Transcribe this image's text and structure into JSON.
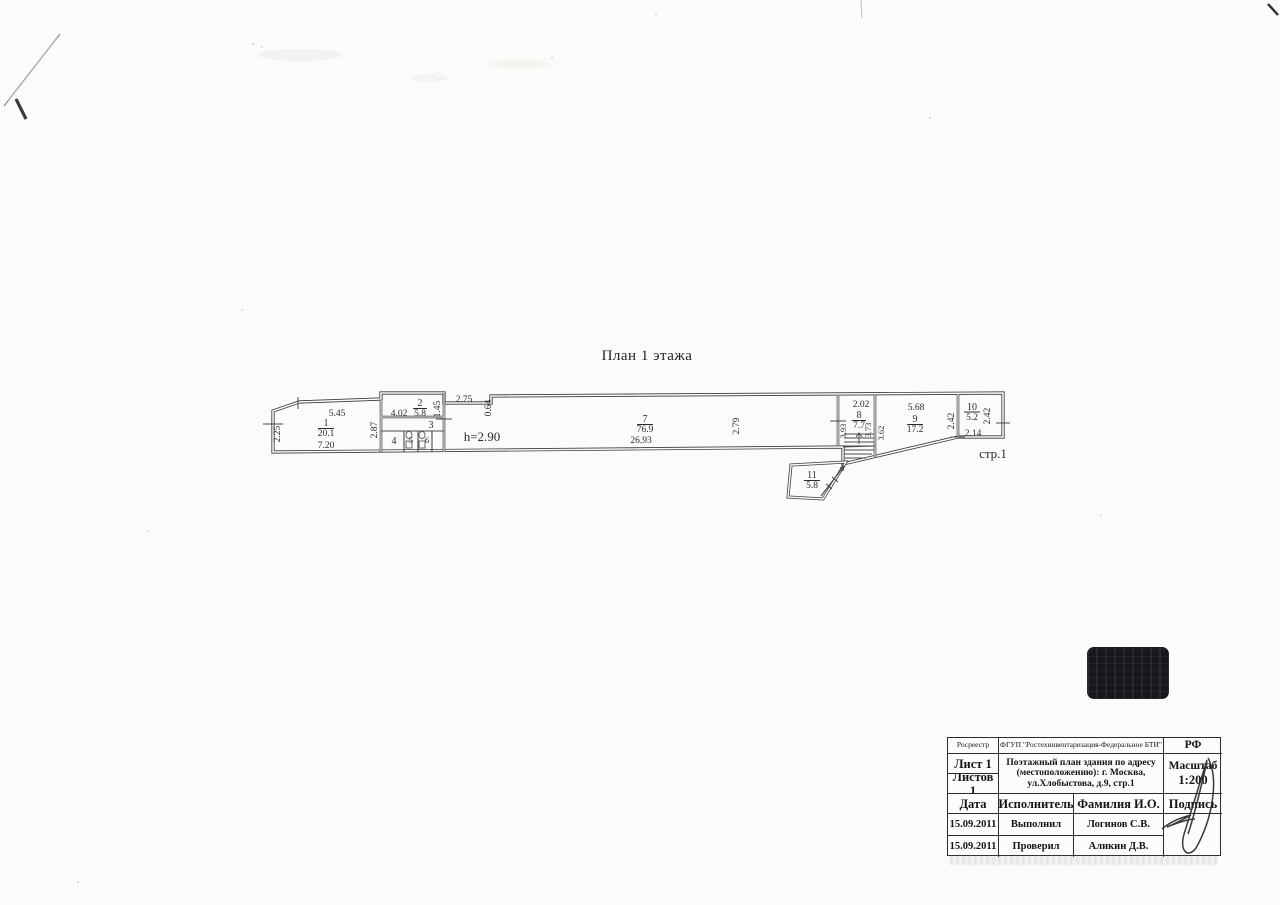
{
  "plan": {
    "title": "План 1 этажа",
    "height_note": "h=2.90",
    "building_label": "стр.1",
    "rooms": {
      "r1": {
        "num": "1",
        "area": "20.1"
      },
      "r2": {
        "num": "2",
        "area": "5.8"
      },
      "r3": {
        "num": "3",
        "area": ""
      },
      "r4": {
        "num": "4",
        "area": ""
      },
      "r5": {
        "num": "5",
        "area": ""
      },
      "r6": {
        "num": "6",
        "area": ""
      },
      "r7": {
        "num": "7",
        "area": "76.9"
      },
      "r8": {
        "num": "8",
        "area": "7.7"
      },
      "r9": {
        "num": "9",
        "area": "17.2"
      },
      "r10": {
        "num": "10",
        "area": "5.2"
      },
      "r11": {
        "num": "11",
        "area": "5.8"
      }
    },
    "dims": {
      "room1_top": "5.45",
      "room1_left": "2.25",
      "room1_bottom": "7.20",
      "room1_right": "2.87",
      "room2_left": "4.02",
      "room2_right": "1.45",
      "notch_top": "2.75",
      "notch_step": "0.64",
      "room7_bottom": "26.93",
      "room7_mid": "2.79",
      "room8_top": "2.02",
      "room8_left": "3.93",
      "room8_right": "3.73",
      "room9_left": "3.62",
      "room9_top": "5.68",
      "room9_right": "2.42",
      "room10_right": "2.42",
      "room10_bottom": "2.14"
    }
  },
  "title_block": {
    "org_left": "Росреестр",
    "org_center": "ФГУП \"Ростехинвентаризация-Федеральное БТИ\"",
    "org_right": "РФ",
    "sheet": "Лист 1",
    "sheets_total": "Листов 1",
    "doc_line1": "Поэтажный план здания по адресу",
    "doc_line2": "(местоположению): г. Москва,",
    "doc_line3": "ул.Хлобыстова, д.9, стр.1",
    "scale_label": "Масштаб",
    "scale_value": "1:200",
    "col_date": "Дата",
    "col_role": "Исполнитель",
    "col_name": "Фамилия И.О.",
    "col_sign": "Подпись",
    "rows": [
      {
        "date": "15.09.2011",
        "role": "Выполнил",
        "name": "Логинов С.В."
      },
      {
        "date": "15.09.2011",
        "role": "Проверил",
        "name": "Аликин Д.В."
      }
    ]
  },
  "colors": {
    "paper": "#fbfbf9",
    "ink": "#2b2b2b",
    "wall": "#3b3b3b",
    "stamp": "#17171c"
  }
}
